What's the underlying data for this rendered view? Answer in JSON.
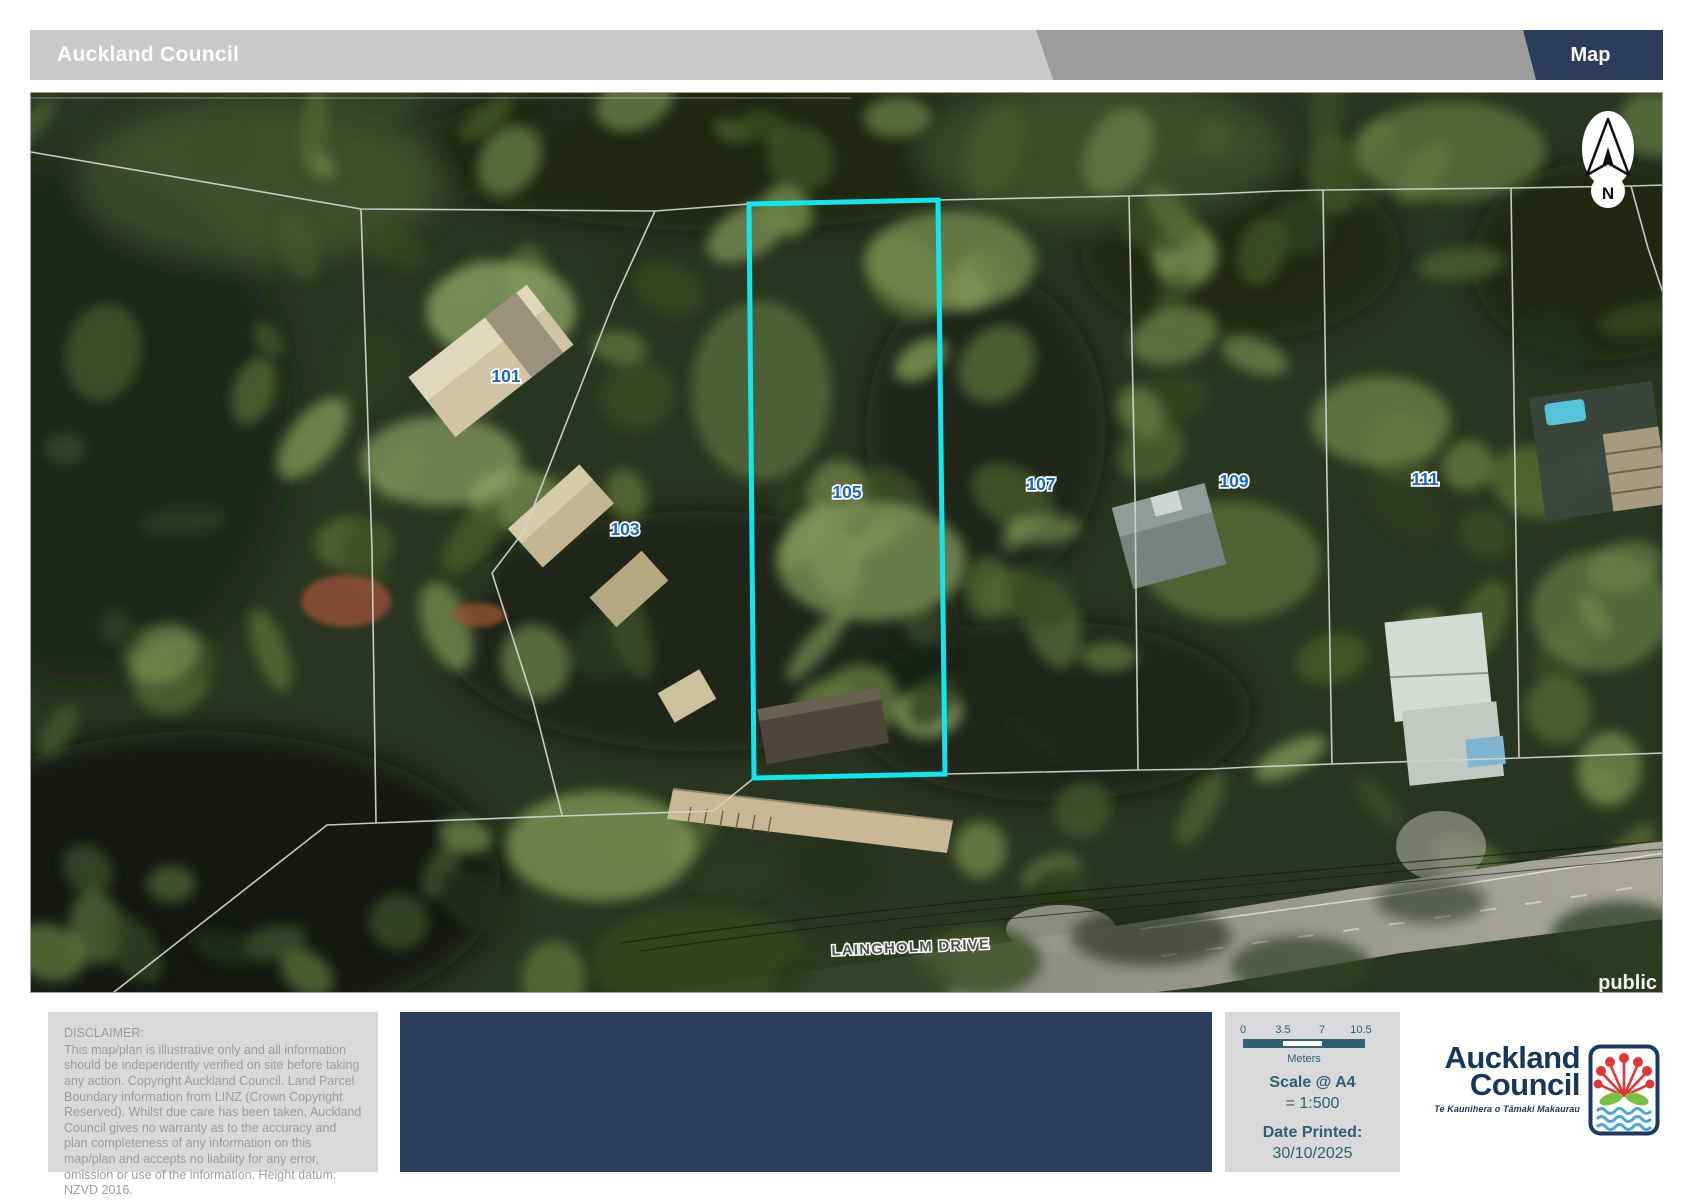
{
  "header": {
    "title": "Auckland Council",
    "page_label": "Map"
  },
  "map": {
    "street_label": "LAINGHOLM DRIVE",
    "watermark": "public",
    "north_label": "N",
    "highlight_color": "#10e6ef",
    "parcels": [
      {
        "label": "101"
      },
      {
        "label": "103"
      },
      {
        "label": "105"
      },
      {
        "label": "107"
      },
      {
        "label": "109"
      },
      {
        "label": "111"
      }
    ]
  },
  "footer": {
    "disclaimer_heading": "DISCLAIMER:",
    "disclaimer_body": "This map/plan is illustrative only and all information should be independently verified on site before taking any action. Copyright Auckland Council.  Land Parcel Boundary information from LINZ (Crown Copyright Reserved). Whilst due care has been taken, Auckland Council gives no warranty as to the accuracy and plan completeness of any information on this map/plan and accepts no liability for any error, omission or use of the information. Height datum: NZVD 2016.",
    "scale_panel": {
      "ticks": [
        "0",
        "3.5",
        "7",
        "10.5"
      ],
      "unit": "Meters",
      "scale_heading": "Scale @ A4",
      "scale_value": "=  1:500",
      "date_heading": "Date Printed:",
      "date_value": "30/10/2025"
    },
    "logo": {
      "line1": "Auckland",
      "line2": "Council",
      "tagline": "Te Kaunihera o Tāmaki Makaurau"
    }
  }
}
